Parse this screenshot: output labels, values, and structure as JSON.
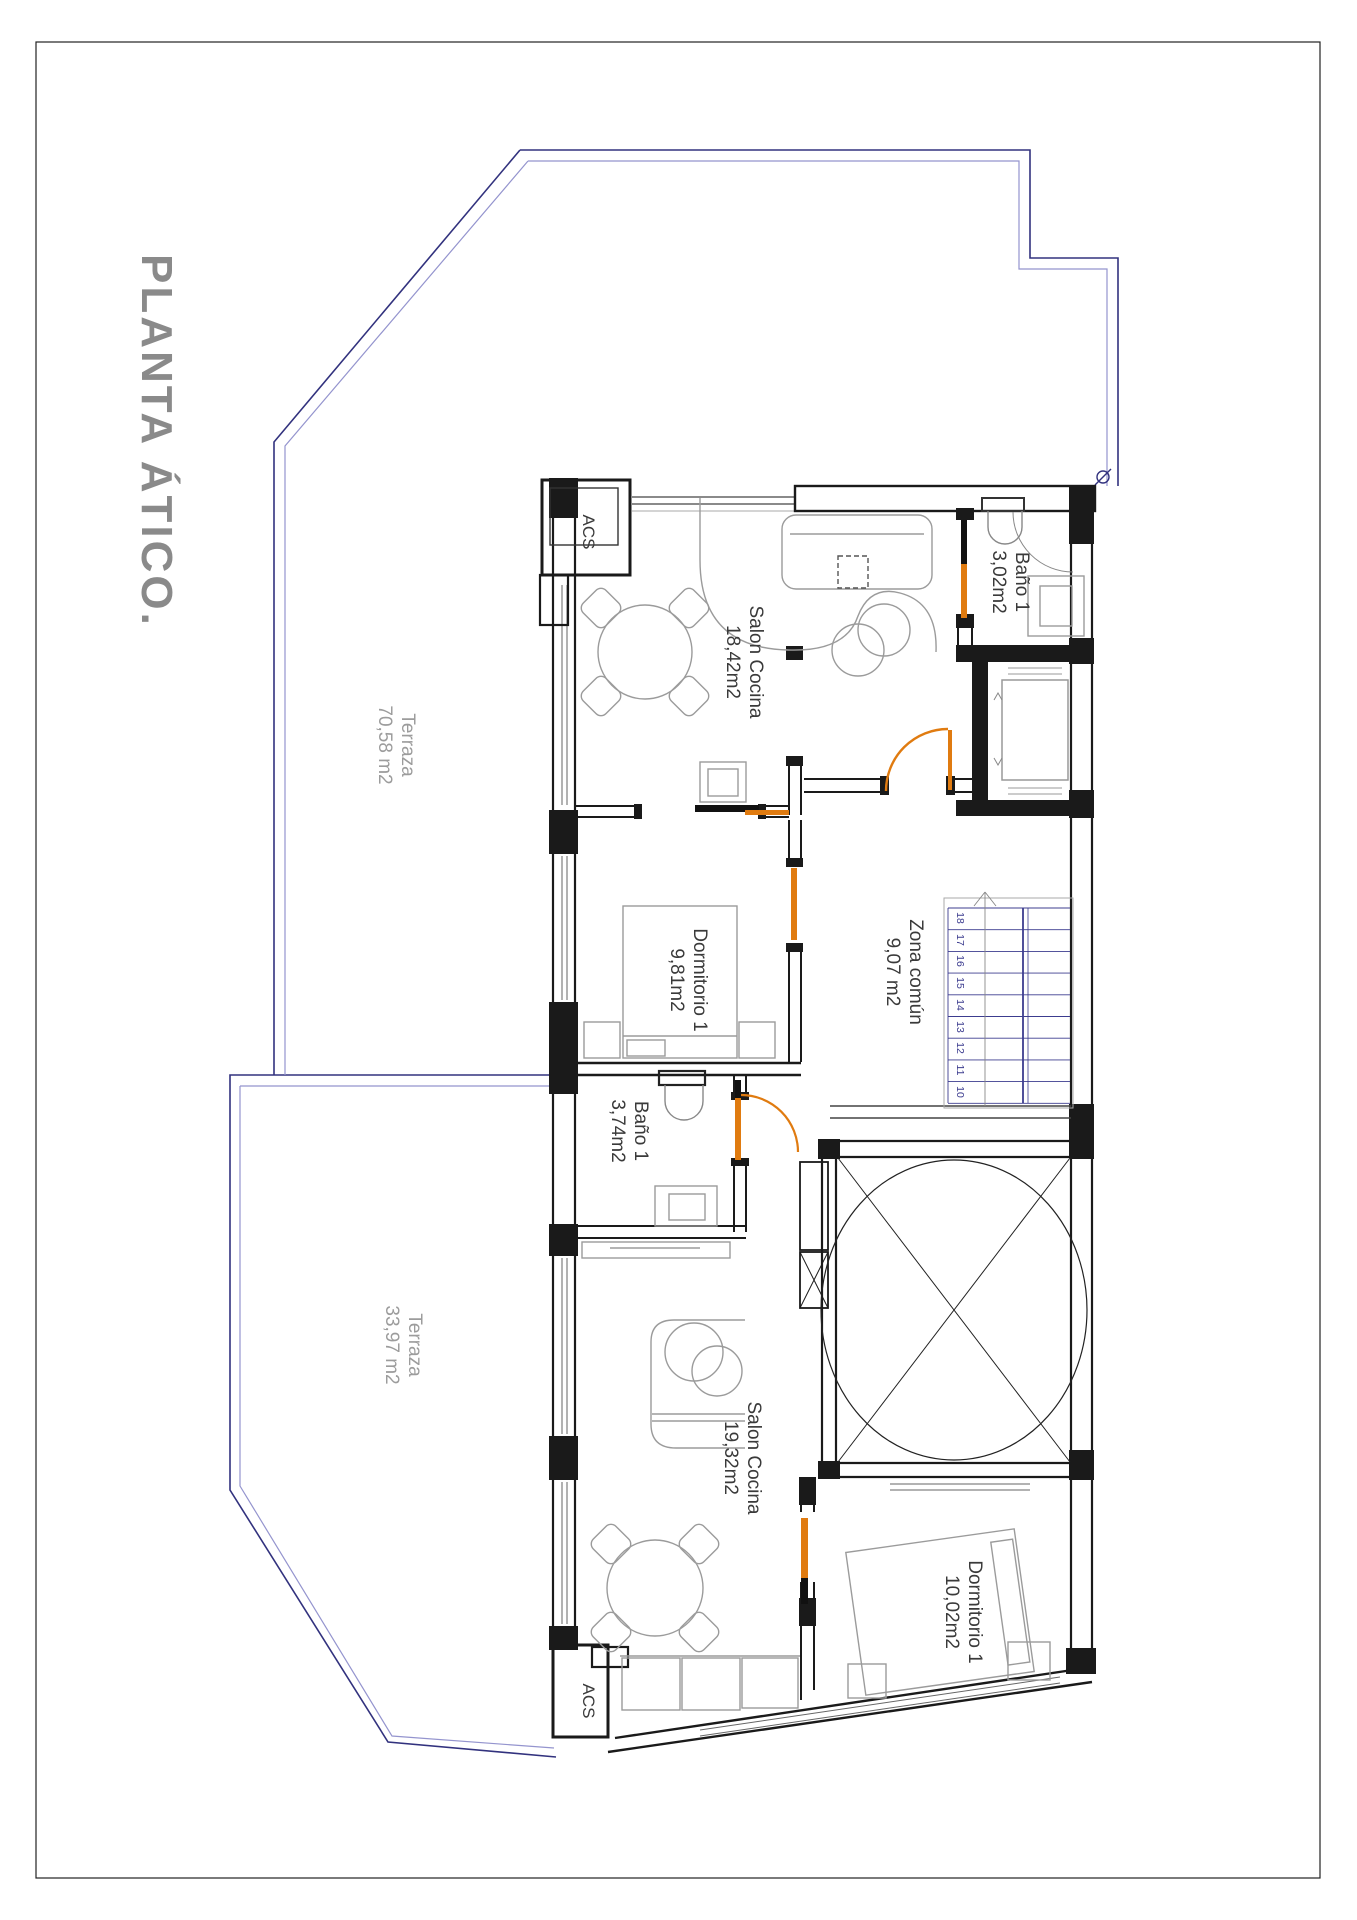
{
  "title": {
    "text": "PLANTA ÁTICO.",
    "color": "#8a8a8a"
  },
  "colors": {
    "wall": "#1a1a1a",
    "furniture": "#9b9b9b",
    "terrace_outline_outer": "#32327e",
    "terrace_outline_inner": "#9494ce",
    "door_orange": "#e07b10",
    "stair_blue": "#3c3c8f",
    "room_label": "#3a3a3a",
    "muted_label": "#9c9c9c"
  },
  "labels": {
    "terraza_a": {
      "line1": "Terraza",
      "line2": "70,58 m2"
    },
    "terraza_b": {
      "line1": "Terraza",
      "line2": "33,97 m2"
    },
    "salon_a": {
      "line1": "Salon Cocina",
      "line2": "18,42m2"
    },
    "bano_a": {
      "line1": "Baño 1",
      "line2": "3,02m2"
    },
    "dorm_a": {
      "line1": "Dormitorio 1",
      "line2": "9,81m2"
    },
    "zona_comun": {
      "line1": "Zona común",
      "line2": "9,07 m2"
    },
    "bano_b": {
      "line1": "Baño 1",
      "line2": "3,74m2"
    },
    "salon_b": {
      "line1": "Salon Cocina",
      "line2": "19,32m2"
    },
    "dorm_b": {
      "line1": "Dormitorio 1",
      "line2": "10,02m2"
    },
    "acs_top": "ACS",
    "acs_bottom": "ACS"
  },
  "stairs": {
    "steps": [
      "18",
      "17",
      "16",
      "15",
      "14",
      "13",
      "12",
      "11",
      "10"
    ]
  }
}
